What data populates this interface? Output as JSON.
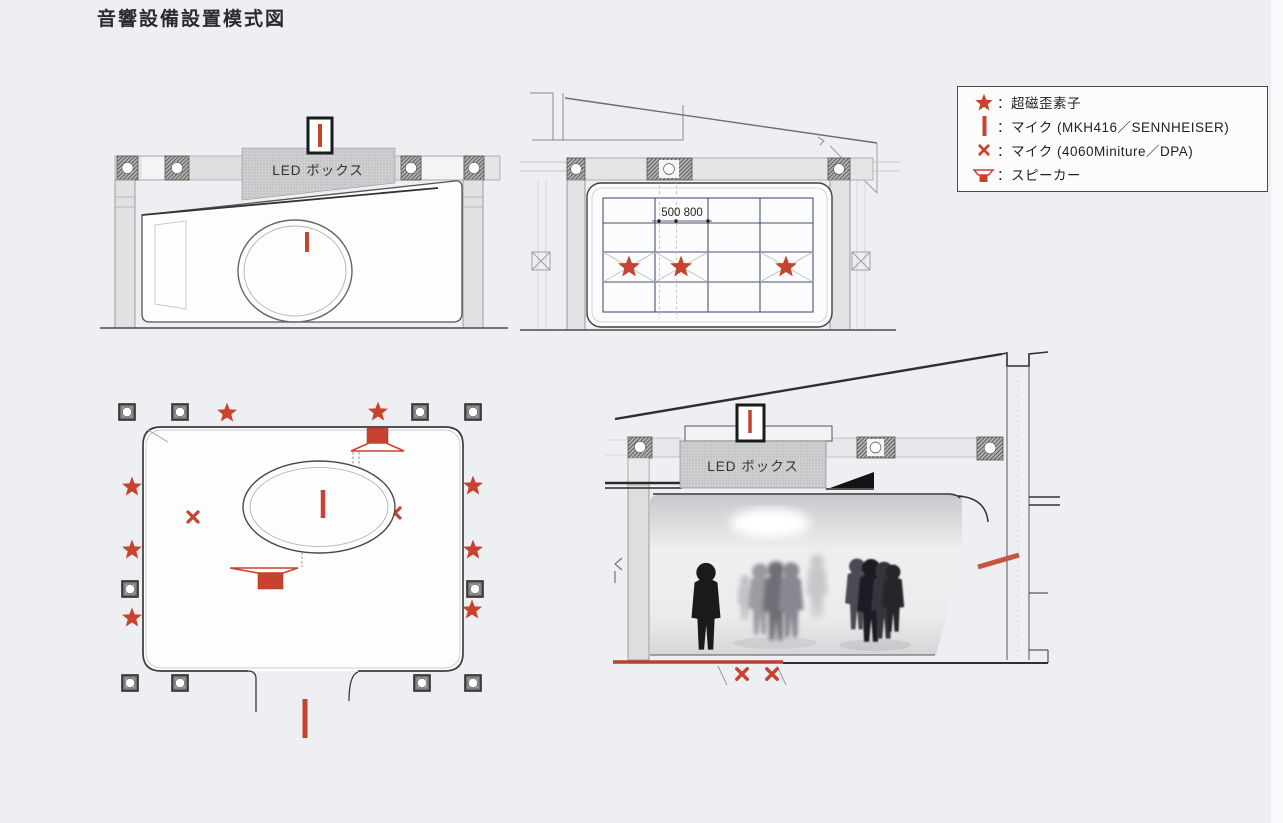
{
  "title": "音響設備設置模式図",
  "legend": {
    "items": [
      {
        "icon": "magnetostrictive-star-icon",
        "label": "：超磁歪素子"
      },
      {
        "icon": "mic-line-icon",
        "label": "：マイク (MKH416／SENNHEISER)"
      },
      {
        "icon": "mic-x-icon",
        "label": "：マイク (4060Miniture／DPA)"
      },
      {
        "icon": "speaker-icon",
        "label": "：スピーカー"
      }
    ]
  },
  "drawings": {
    "front_elevation": {
      "led_box_label": "LED ボックス"
    },
    "rear_elevation": {
      "dimension_label": "500 800"
    },
    "section": {
      "led_box_label": "LED ボックス"
    }
  },
  "colors": {
    "accent_red": "#c8432f",
    "grid_blue": "#46507a",
    "background": "#edeff3"
  }
}
